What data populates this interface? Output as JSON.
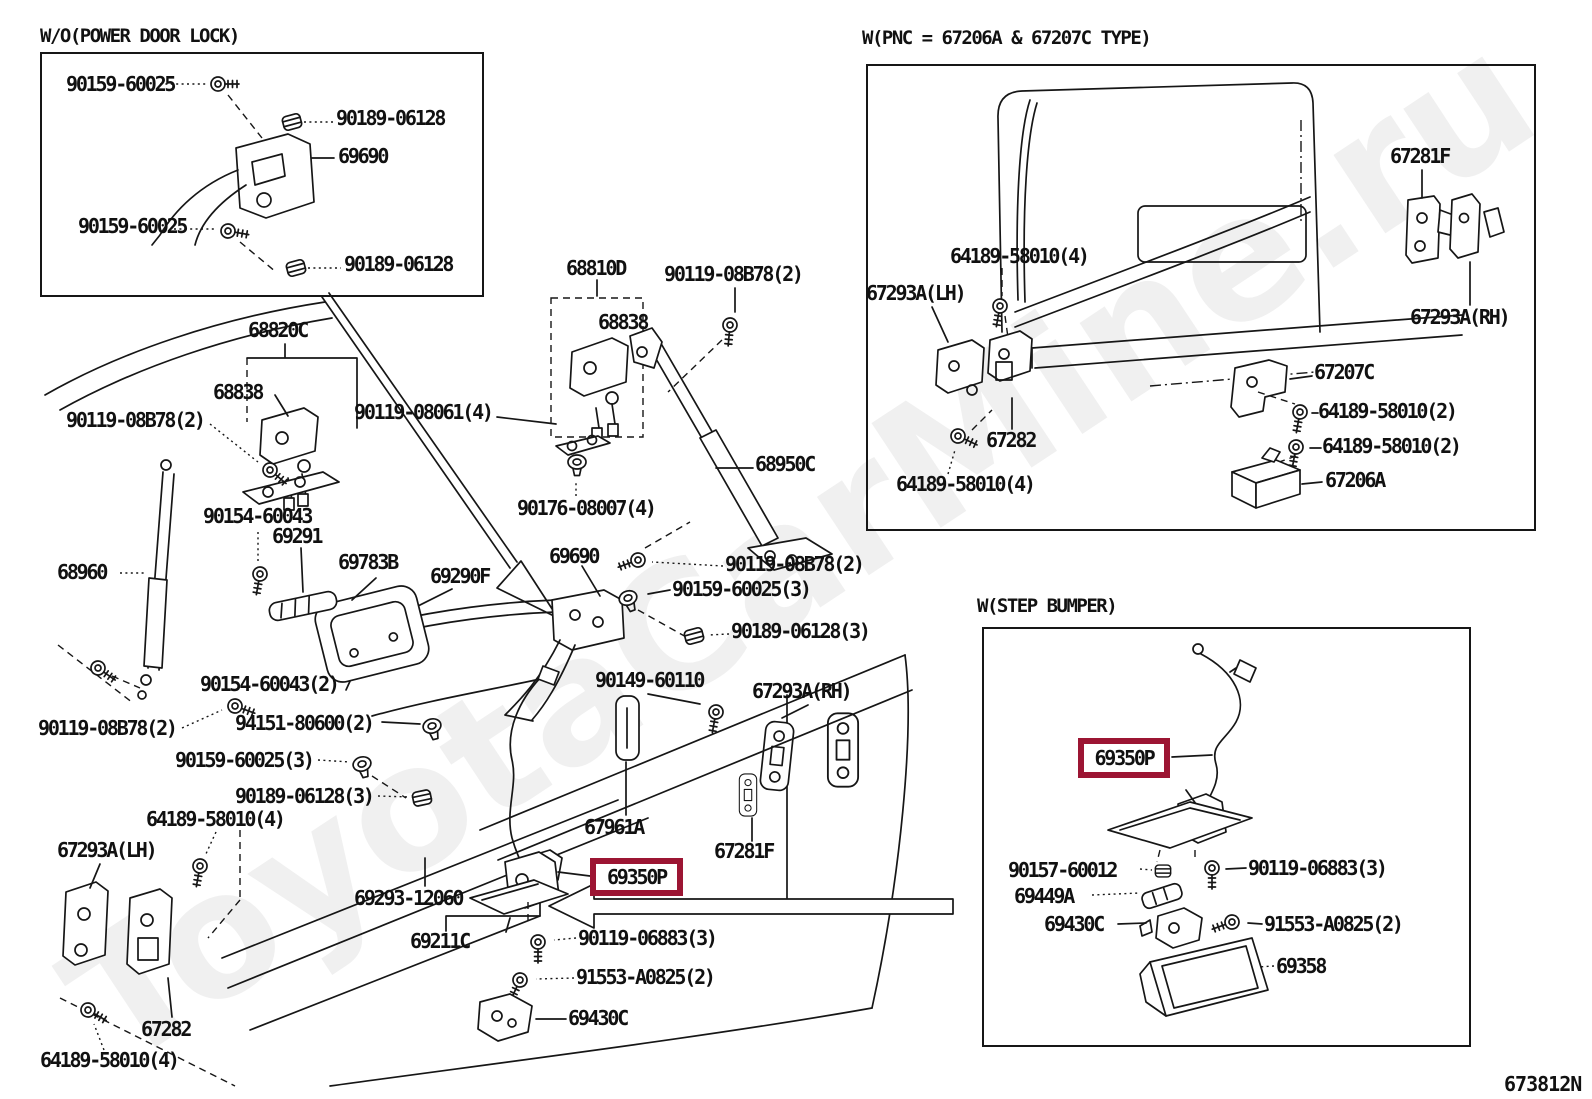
{
  "diagram_code": "673812N",
  "watermark": "ToyotaCarMine.ru",
  "highlight_color": "#9c1533",
  "insets": [
    {
      "title": "W/O(POWER DOOR LOCK)"
    },
    {
      "title": "W(PNC = 67206A & 67207C TYPE)"
    },
    {
      "title": "W(STEP BUMPER)"
    }
  ],
  "labels": [
    {
      "t": "90159-60025",
      "x": 66,
      "y": 74
    },
    {
      "t": "90189-06128",
      "x": 336,
      "y": 108
    },
    {
      "t": "69690",
      "x": 338,
      "y": 146
    },
    {
      "t": "90159-60025",
      "x": 78,
      "y": 216
    },
    {
      "t": "90189-06128",
      "x": 344,
      "y": 254
    },
    {
      "t": "68810D",
      "x": 566,
      "y": 258
    },
    {
      "t": "90119-08B78(2)",
      "x": 664,
      "y": 264
    },
    {
      "t": "68838",
      "x": 598,
      "y": 312
    },
    {
      "t": "68820C",
      "x": 248,
      "y": 320
    },
    {
      "t": "68838",
      "x": 213,
      "y": 382
    },
    {
      "t": "90119-08061(4)",
      "x": 354,
      "y": 402
    },
    {
      "t": "90119-08B78(2)",
      "x": 66,
      "y": 410
    },
    {
      "t": "68950C",
      "x": 755,
      "y": 454
    },
    {
      "t": "90176-08007(4)",
      "x": 517,
      "y": 498
    },
    {
      "t": "90154-60043",
      "x": 203,
      "y": 506
    },
    {
      "t": "69291",
      "x": 272,
      "y": 526
    },
    {
      "t": "69783B",
      "x": 338,
      "y": 552
    },
    {
      "t": "69290F",
      "x": 430,
      "y": 566
    },
    {
      "t": "68960",
      "x": 57,
      "y": 562
    },
    {
      "t": "69690",
      "x": 549,
      "y": 546
    },
    {
      "t": "90119-08B78(2)",
      "x": 725,
      "y": 554
    },
    {
      "t": "90159-60025(3)",
      "x": 672,
      "y": 579
    },
    {
      "t": "90189-06128(3)",
      "x": 731,
      "y": 621
    },
    {
      "t": "90149-60110",
      "x": 595,
      "y": 670
    },
    {
      "t": "67293A(RH)",
      "x": 752,
      "y": 681
    },
    {
      "t": "90154-60043(2)",
      "x": 200,
      "y": 674
    },
    {
      "t": "90119-08B78(2)",
      "x": 38,
      "y": 718
    },
    {
      "t": "94151-80600(2)",
      "x": 235,
      "y": 713
    },
    {
      "t": "90159-60025(3)",
      "x": 175,
      "y": 750
    },
    {
      "t": "90189-06128(3)",
      "x": 235,
      "y": 786
    },
    {
      "t": "64189-58010(4)",
      "x": 146,
      "y": 809
    },
    {
      "t": "67293A(LH)",
      "x": 57,
      "y": 840
    },
    {
      "t": "69293-12060",
      "x": 354,
      "y": 888
    },
    {
      "t": "69211C",
      "x": 410,
      "y": 931
    },
    {
      "t": "67961A",
      "x": 584,
      "y": 817
    },
    {
      "t": "67281F",
      "x": 714,
      "y": 841
    },
    {
      "t": "69350P",
      "x": 590,
      "y": 858,
      "hl": true,
      "w": 93,
      "h": 38
    },
    {
      "t": "90119-06883(3)",
      "x": 578,
      "y": 928
    },
    {
      "t": "91553-A0825(2)",
      "x": 576,
      "y": 967
    },
    {
      "t": "69430C",
      "x": 568,
      "y": 1008
    },
    {
      "t": "67282",
      "x": 141,
      "y": 1019
    },
    {
      "t": "64189-58010(4)",
      "x": 40,
      "y": 1050
    },
    {
      "t": "67281F",
      "x": 1390,
      "y": 146
    },
    {
      "t": "64189-58010(4)",
      "x": 950,
      "y": 246
    },
    {
      "t": "67293A(LH)",
      "x": 866,
      "y": 283
    },
    {
      "t": "67293A(RH)",
      "x": 1410,
      "y": 307
    },
    {
      "t": "67207C",
      "x": 1314,
      "y": 362
    },
    {
      "t": "64189-58010(2)",
      "x": 1318,
      "y": 401
    },
    {
      "t": "64189-58010(2)",
      "x": 1322,
      "y": 436
    },
    {
      "t": "67206A",
      "x": 1325,
      "y": 470
    },
    {
      "t": "67282",
      "x": 986,
      "y": 430
    },
    {
      "t": "64189-58010(4)",
      "x": 896,
      "y": 474
    },
    {
      "t": "69350P",
      "x": 1078,
      "y": 738,
      "hl": true,
      "w": 92,
      "h": 40
    },
    {
      "t": "90157-60012",
      "x": 1008,
      "y": 860
    },
    {
      "t": "90119-06883(3)",
      "x": 1248,
      "y": 858
    },
    {
      "t": "69449A",
      "x": 1014,
      "y": 886
    },
    {
      "t": "69430C",
      "x": 1044,
      "y": 914
    },
    {
      "t": "91553-A0825(2)",
      "x": 1264,
      "y": 914
    },
    {
      "t": "69358",
      "x": 1276,
      "y": 956
    }
  ]
}
